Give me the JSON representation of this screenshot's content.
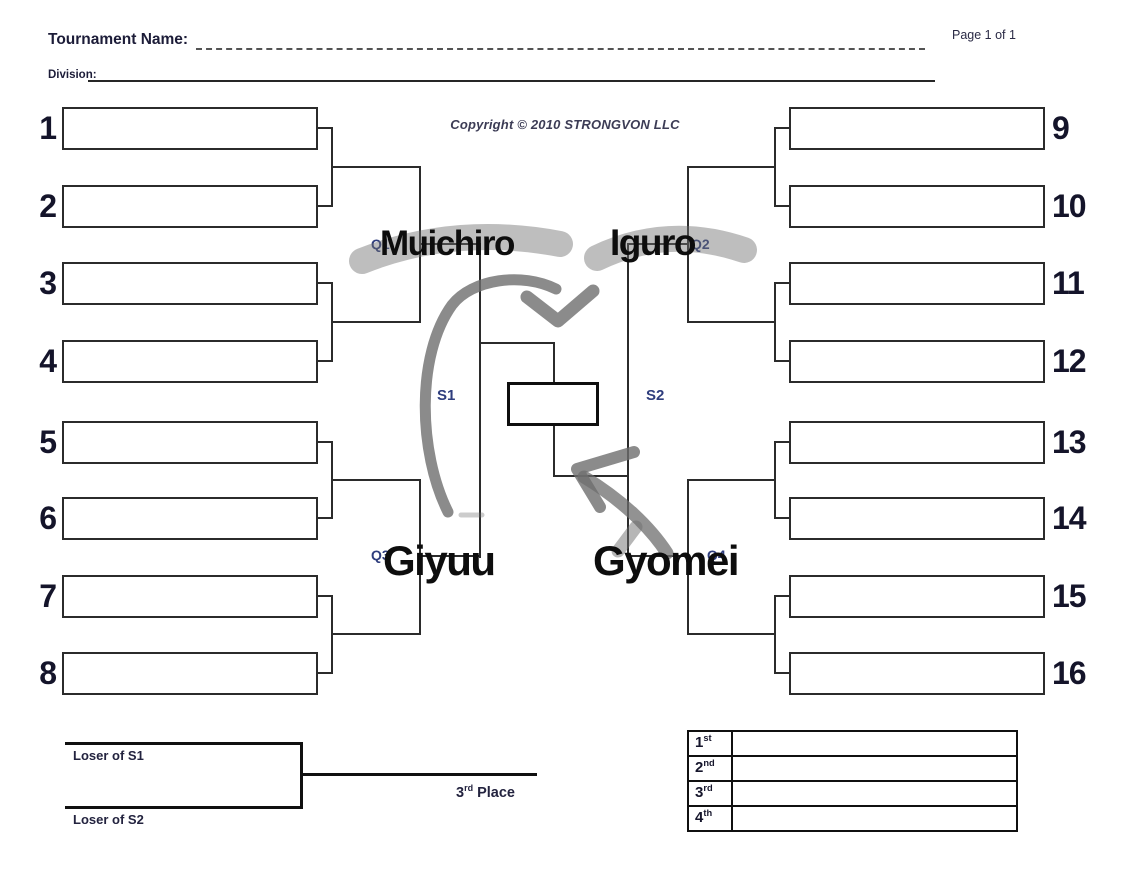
{
  "page": {
    "title": "Tournament Name:",
    "page_indicator": "Page 1 of 1",
    "division_label": "Division:",
    "copyright": "Copyright © 2010 STRONGVON LLC"
  },
  "bracket": {
    "left_seeds": [
      "1",
      "2",
      "3",
      "4",
      "5",
      "6",
      "7",
      "8"
    ],
    "right_seeds": [
      "9",
      "10",
      "11",
      "12",
      "13",
      "14",
      "15",
      "16"
    ],
    "labels": {
      "q1": "Q1",
      "q2": "Q2",
      "q3": "Q3",
      "q4": "Q4",
      "s1": "S1",
      "s2": "S2"
    }
  },
  "handwriting": {
    "q1_winner": "Muichiro",
    "q2_winner": "Iguro",
    "q3_winner": "Giyuu",
    "q4_winner": "Gyomei",
    "ink_color": "#0d0d0d",
    "marker_color": "#6e6e6e"
  },
  "third_place_bracket": {
    "top_label": "Loser of S1",
    "bottom_label": "Loser of S2",
    "place_number": "3",
    "place_suffix": "rd",
    "place_text": " Place"
  },
  "results_table": {
    "rows": [
      {
        "place": "1",
        "suffix": "st",
        "name": ""
      },
      {
        "place": "2",
        "suffix": "nd",
        "name": ""
      },
      {
        "place": "3",
        "suffix": "rd",
        "name": ""
      },
      {
        "place": "4",
        "suffix": "th",
        "name": ""
      }
    ]
  }
}
